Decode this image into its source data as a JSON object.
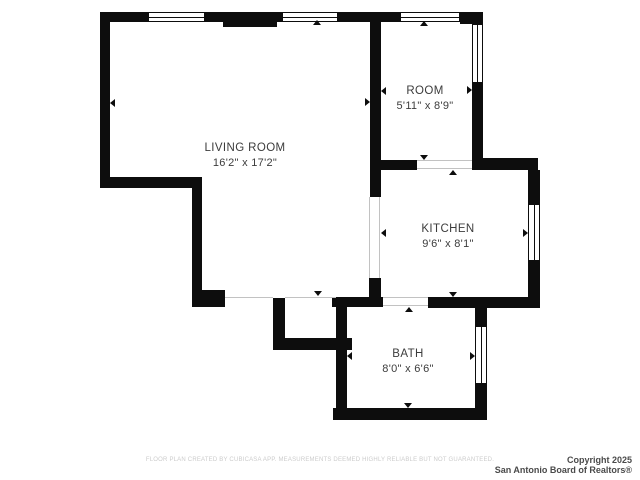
{
  "page": {
    "background_color": "#ffffff",
    "wall_color": "#0d0d0d",
    "text_color": "#3c3c3c"
  },
  "floorplan": {
    "rooms": [
      {
        "id": "living-room",
        "name": "LIVING ROOM",
        "dims": "16'2\" x 17'2\""
      },
      {
        "id": "room",
        "name": "ROOM",
        "dims": "5'11\" x 8'9\""
      },
      {
        "id": "kitchen",
        "name": "KITCHEN",
        "dims": "9'6\" x 8'1\""
      },
      {
        "id": "bath",
        "name": "BATH",
        "dims": "8'0\" x 6'6\""
      }
    ],
    "window_count": 6,
    "door_opening_count": 5
  },
  "footer": {
    "disclaimer": "FLOOR PLAN CREATED BY CUBICASA APP. MEASUREMENTS DEEMED HIGHLY RELIABLE BUT NOT GUARANTEED.",
    "copyright_line1": "Copyright 2025",
    "copyright_line2": "San Antonio Board of Realtors®"
  }
}
